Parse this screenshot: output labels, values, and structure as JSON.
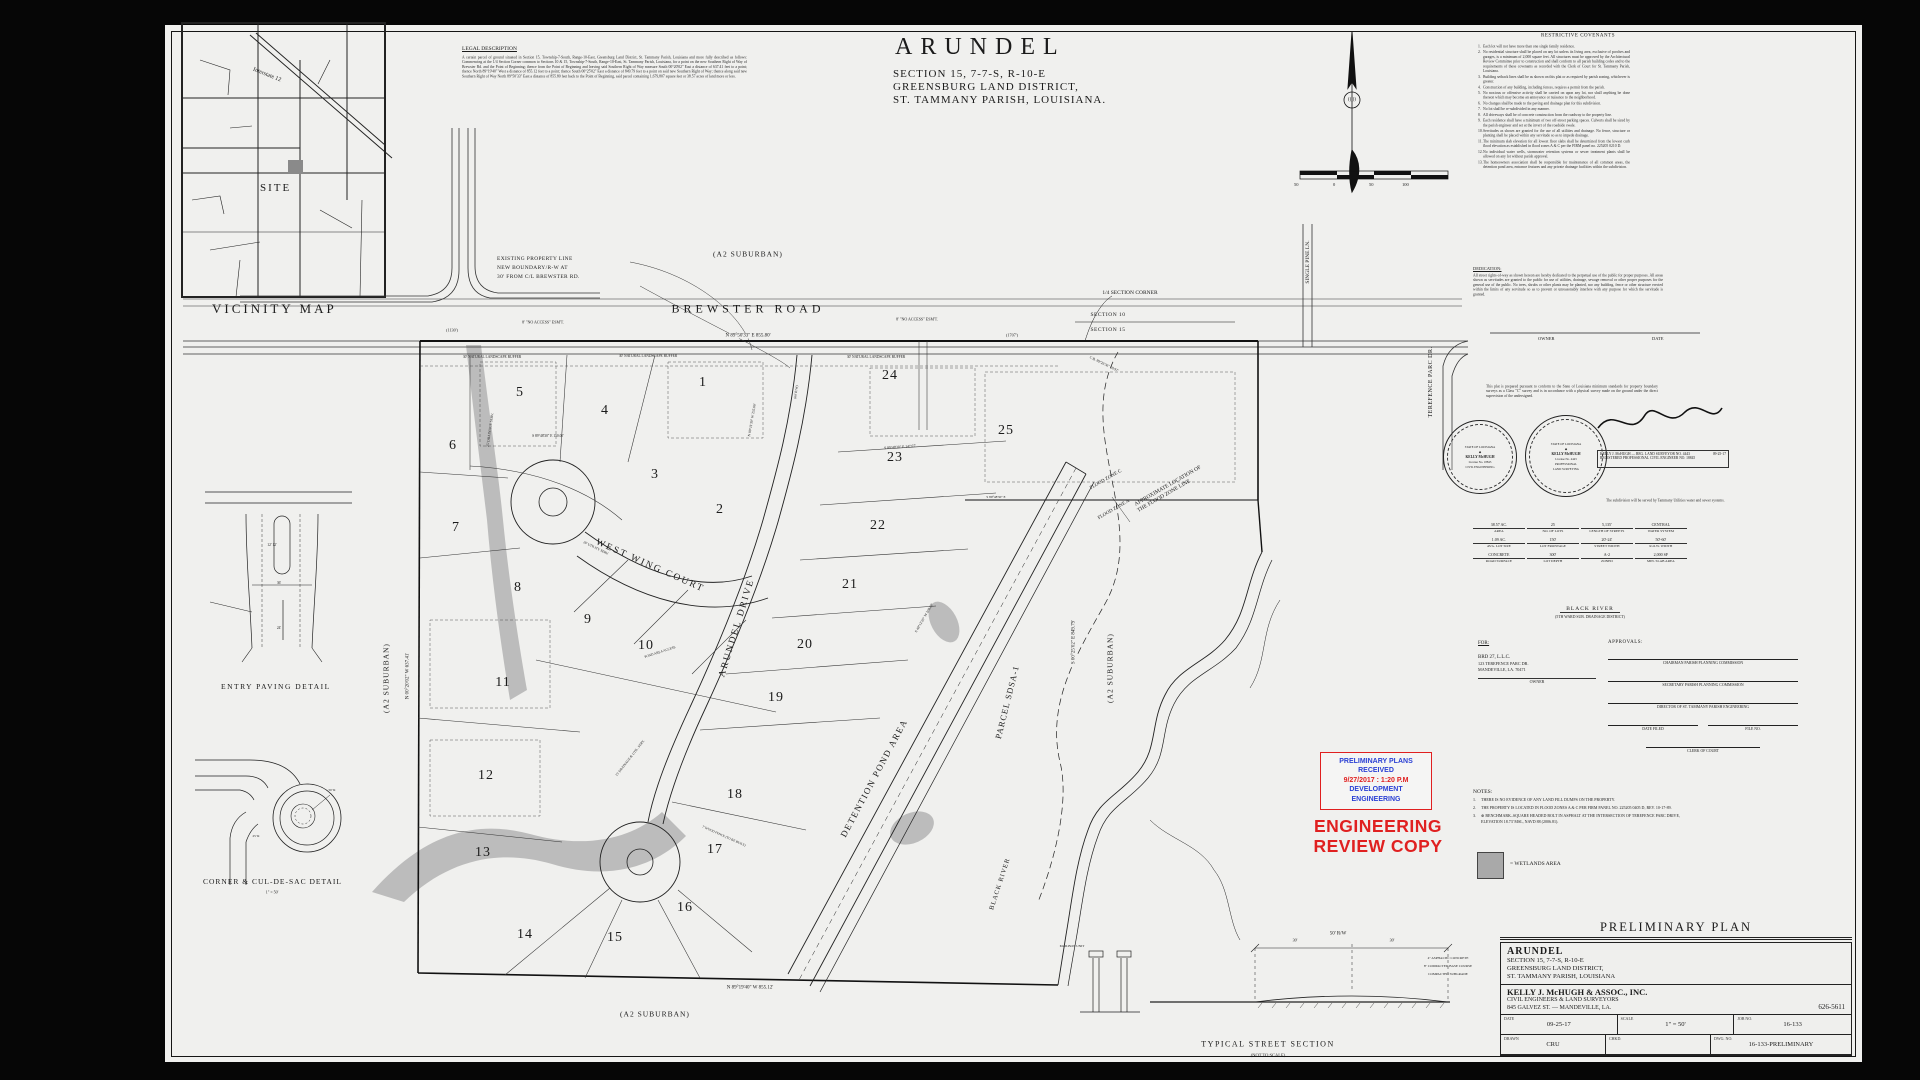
{
  "title": {
    "name": "ARUNDEL",
    "line1": "SECTION 15, 7-7-S, R-10-E",
    "line2": "GREENSBURG LAND DISTRICT,",
    "line3": "ST. TAMMANY PARISH, LOUISIANA."
  },
  "vicinity": {
    "caption": "VICINITY MAP",
    "site_label": "SITE",
    "interstate_label": "Interstate 12"
  },
  "details": {
    "entry_paving": "ENTRY PAVING DETAIL",
    "corner_culdesac": "CORNER & CUL-DE-SAC DETAIL",
    "culdesac_scale": "1\" = 50'",
    "street_section": "TYPICAL STREET SECTION",
    "street_section_scale": "(NOT TO SCALE)"
  },
  "legal": {
    "heading": "LEGAL DESCRIPTION",
    "body": "A certain parcel of ground situated in Section 15, Township-7-South, Range-10-East, Greensburg Land District, St. Tammany Parish, Louisiana and more fully described as follows:  Commencing at the 1/4 Section Corner common to Sections 10 & 15, Township-7-South, Range-10-East, St. Tammany Parish, Louisiana, for a point on the new Southern Right of Way of Brewster Rd. and the Point of Beginning; thence from the Point of Beginning and leaving said Southern Right of Way measure South 00°20'02\" East a distance of 637.41 feet to a point; thence North 89°19'40\" West a distance of 855.12 feet to a point; thence South 00°25'02\" East a distance of 849.79 feet to a point on said new Southern Right of Way; thence along said new Southern Right of Way North 89°50'33\" East a distance of 855.80 feet back to the Point of Beginning, said parcel containing 1,679,807 square feet or 38.57 acres of land more or less."
  },
  "covenants": {
    "heading": "RESTRICTIVE COVENANTS",
    "items": [
      "Each lot will not have more than one single family residence.",
      "No residential structure shall be placed on any lot unless its living area, exclusive of porches and garages, is a minimum of 2,000 square feet. All structures must be approved by the Architectural Review Committee prior to construction and shall conform to all parish building codes and to the requirements of these covenants as recorded with the Clerk of Court for St. Tammany Parish, Louisiana.",
      "Building setback lines shall be as shown on this plat or as required by parish zoning, whichever is greater.",
      "Construction of any building, including fences, requires a permit from the parish.",
      "No noxious or offensive activity shall be carried on upon any lot, nor shall anything be done thereon which may become an annoyance or nuisance to the neighborhood.",
      "No changes shall be made to the paving and drainage plan for this subdivision.",
      "No lot shall be re-subdivided in any manner.",
      "All driveways shall be of concrete construction from the roadway to the property line.",
      "Each residence shall have a minimum of two off-street parking spaces. Culverts shall be sized by the parish engineer and set at the invert of the roadside swale.",
      "Servitudes as shown are granted for the use of all utilities and drainage. No fence, structure or planting shall be placed within any servitude so as to impede drainage.",
      "The minimum slab elevation for all lowest floor slabs shall be determined from the lowest curb flood elevation as established in flood zones A & C per the FIRM panel no. 225205 0210 D.",
      "No individual water wells, stormwater retention systems or sewer treatment plants shall be allowed on any lot without parish approval.",
      "The homeowners association shall be responsible for maintenance of all common areas, the detention pond area, entrance features and any private drainage facilities within the subdivision."
    ]
  },
  "dedication": {
    "heading": "DEDICATION:",
    "body": "All street rights-of-way as shown hereon are hereby dedicated to the perpetual use of the public for proper purposes. All areas shown as servitudes are granted to the public for use of utilities, drainage, sewage removal or other proper purposes for the general use of the public. No trees, shrubs or other plants may be planted, nor any building, fence or other structure erected within the limits of any servitude so as to prevent or unreasonably interfere with any purpose for which the servitude is granted."
  },
  "certification": "This plat is prepared pursuant to conform to the State of Louisiana minimum standards for property boundary surveys as a Class \"C\" survey and is in accordance with a physical survey made on the ground under the direct supervision of the undersigned.",
  "service_note": "The subdivision will be served by Tammany Utilities water and sewer systems.",
  "owner_line": {
    "owner": "OWNER",
    "date": "DATE"
  },
  "seals": [
    {
      "state": "STATE OF LOUISIANA",
      "name": "KELLY McHUGH",
      "lic": "License No. 18845",
      "title": "REGISTERED ENGINEER",
      "field": "CIVIL ENGINEERING"
    },
    {
      "state": "STATE OF LOUISIANA",
      "name": "KELLY McHUGH",
      "lic": "License No. 4443",
      "title": "PROFESSIONAL",
      "field": "LAND SURVEYING"
    }
  ],
  "sig_box": {
    "l1": "KELLY J. McHUGH — REG. LAND SURVEYOR NO. 4443",
    "l2": "REGISTERED PROFESSIONAL CIVIL ENGINEER NO. 18845",
    "date": "09-25-17"
  },
  "statistics": [
    {
      "v": "38.57 AC.",
      "l": "AREA"
    },
    {
      "v": "25",
      "l": "NO. OF LOTS"
    },
    {
      "v": "5,135'",
      "l": "LENGTH OF STREETS"
    },
    {
      "v": "CENTRAL",
      "l": "WATER SYSTEM"
    },
    {
      "v": "1.09 AC.",
      "l": "AVG. LOT SIZE"
    },
    {
      "v": "150'",
      "l": "LOT FRONTAGE"
    },
    {
      "v": "20'-24'",
      "l": "STREET WIDTH"
    },
    {
      "v": "50'-60'",
      "l": "R.O.W. WIDTH"
    },
    {
      "v": "CONCRETE",
      "l": "ROAD SURFACE"
    },
    {
      "v": "300'",
      "l": "LOT DEPTH"
    },
    {
      "v": "A-2",
      "l": "ZONED"
    },
    {
      "v": "2,000 SF",
      "l": "MIN. SLAB AREA"
    }
  ],
  "black_river_note": {
    "l1": "BLACK RIVER",
    "l2": "(5TH WARD SUB. DRAINAGE DISTRICT)"
  },
  "for_block": {
    "heading": "FOR:",
    "owner": "BRD 27, L.L.C.",
    "addr1": "123 TEREFENCE PARC DR.",
    "addr2": "MANDEVILLE, LA. 70471",
    "label": "OWNER"
  },
  "approvals": {
    "heading": "APPROVALS:",
    "sign_lines": [
      "CHAIRMAN PARISH PLANNING COMMISSION",
      "SECRETARY PARISH PLANNING COMMISSION",
      "DIRECTOR OF ST. TAMMANY PARISH ENGINEERING"
    ],
    "half_lines": [
      "DATE FILED",
      "FILE NO."
    ],
    "clerk": "CLERK OF COURT"
  },
  "stamp": {
    "line1": "PRELIMINARY PLANS",
    "line2": "RECEIVED",
    "line3": "9/27/2017 : 1:20 P.M",
    "line4": "DEVELOPMENT",
    "line5": "ENGINEERING",
    "review1": "ENGINEERING",
    "review2": "REVIEW COPY"
  },
  "notes": {
    "heading": "NOTES:",
    "items": [
      "THERE IS NO EVIDENCE OF ANY LAND FILL DUMPS ON THE PROPERTY.",
      "THE PROPERTY IS LOCATED IN FLOOD ZONES A & C PER FIRM PANEL NO. 225205 0405 D, REV. 10-17-89.",
      "⊕ BENCHMARK–SQUARE HEADED BOLT IN ASPHALT AT THE INTERSECTION OF TEREFENCE PARC DRIVE, ELEVATION 18.73' MSL, NAVD 88 (2006.81)."
    ],
    "wetland_legend": "= WETLANDS AREA"
  },
  "north_scale": {
    "ticks": [
      "50",
      "0",
      "50",
      "100"
    ]
  },
  "titleblock": {
    "header": "PRELIMINARY PLAN",
    "project": "ARUNDEL",
    "l1": "SECTION 15, 7-7-S, R-10-E",
    "l2": "GREENSBURG LAND DISTRICT,",
    "l3": "ST. TAMMANY PARISH, LOUISIANA",
    "firm": "KELLY J. McHUGH & ASSOC., INC.",
    "firm2": "CIVIL ENGINEERS & LAND SURVEYORS",
    "firm3": "845 GALVEZ ST.  —  MANDEVILLE, LA.",
    "phone": "626-5611",
    "fields": [
      {
        "l": "DATE",
        "v": "09-25-17"
      },
      {
        "l": "SCALE",
        "v": "1\" = 50'"
      },
      {
        "l": "JOB NO.",
        "v": "16-133"
      },
      {
        "l": "DRAWN",
        "v": "CRU"
      },
      {
        "l": "CHKD.",
        "v": ""
      },
      {
        "l": "DWG. NO.",
        "v": "16-133-PRELIMINARY"
      }
    ]
  },
  "plat": {
    "roads": {
      "brewster": "BREWSTER ROAD",
      "arundel": "ARUNDEL DRIVE",
      "west_wing": "WEST WING COURT",
      "single_pine": "SINGLE PINE LN.",
      "terefence": "TEREFENCE PARC DR."
    },
    "labels": {
      "detention": "DETENTION POND AREA",
      "parcel": "PARCEL SDSA-1",
      "black_river": "BLACK RIVER",
      "flood_c": "FLOOD ZONE C",
      "flood_a": "FLOOD ZONE A",
      "flood_line1": "APPROXIMATE LOCATION OF",
      "flood_line2": "THE FLOOD ZONE LINE",
      "quarter_corner": "1/4 SECTION CORNER",
      "section10": "SECTION 10",
      "section15": "SECTION 15",
      "a2": "(A2 SUBURBAN)",
      "existing1": "EXISTING PROPERTY LINE",
      "existing2": "NEW BOUNDARY/R-W AT",
      "existing3": "30' FROM C/L BREWSTER RD."
    },
    "bearings": {
      "top": "N 89°50'33\" E   855.80'",
      "bottom": "N 89°19'40\" W   855.12'",
      "left": "N 00°20'02\" W   637.41'",
      "right": "S 00°25'02\" E   849.79'"
    },
    "lots": [
      {
        "number": "1",
        "x": 703,
        "y": 383
      },
      {
        "number": "2",
        "x": 720,
        "y": 510
      },
      {
        "number": "3",
        "x": 655,
        "y": 475
      },
      {
        "number": "4",
        "x": 605,
        "y": 411
      },
      {
        "number": "5",
        "x": 520,
        "y": 393
      },
      {
        "number": "6",
        "x": 453,
        "y": 446
      },
      {
        "number": "7",
        "x": 456,
        "y": 528
      },
      {
        "number": "8",
        "x": 518,
        "y": 588
      },
      {
        "number": "9",
        "x": 588,
        "y": 620
      },
      {
        "number": "10",
        "x": 646,
        "y": 646
      },
      {
        "number": "11",
        "x": 503,
        "y": 683
      },
      {
        "number": "12",
        "x": 486,
        "y": 776
      },
      {
        "number": "13",
        "x": 483,
        "y": 853
      },
      {
        "number": "14",
        "x": 525,
        "y": 935
      },
      {
        "number": "15",
        "x": 615,
        "y": 938
      },
      {
        "number": "16",
        "x": 685,
        "y": 908
      },
      {
        "number": "17",
        "x": 715,
        "y": 850
      },
      {
        "number": "18",
        "x": 735,
        "y": 795
      },
      {
        "number": "19",
        "x": 776,
        "y": 698
      },
      {
        "number": "20",
        "x": 805,
        "y": 645
      },
      {
        "number": "21",
        "x": 850,
        "y": 585
      },
      {
        "number": "22",
        "x": 878,
        "y": 526
      },
      {
        "number": "23",
        "x": 895,
        "y": 458
      },
      {
        "number": "24",
        "x": 890,
        "y": 376
      },
      {
        "number": "25",
        "x": 1006,
        "y": 431
      }
    ],
    "micro": [
      {
        "t": "8' \"NO ACCESS\" ESM'T.",
        "x": 543,
        "y": 322,
        "r": 0,
        "s": 4
      },
      {
        "t": "8' \"NO ACCESS\" ESM'T.",
        "x": 917,
        "y": 319,
        "r": 0,
        "s": 4
      },
      {
        "t": "(1130')",
        "x": 452,
        "y": 330,
        "r": 0,
        "s": 4.2
      },
      {
        "t": "(1707')",
        "x": 1012,
        "y": 335,
        "r": 0,
        "s": 4.2
      },
      {
        "t": "30' NATURAL LANDSCAPE BUFFER",
        "x": 492,
        "y": 357,
        "r": 0,
        "s": 3.6
      },
      {
        "t": "30' NATURAL LANDSCAPE BUFFER",
        "x": 648,
        "y": 356,
        "r": 0,
        "s": 3.6
      },
      {
        "t": "30' NATURAL LANDSCAPE BUFFER",
        "x": 876,
        "y": 357,
        "r": 0,
        "s": 3.6
      },
      {
        "t": "S 89°48'30\" E  150.00'",
        "x": 548,
        "y": 436,
        "r": 0,
        "s": 3.6
      },
      {
        "t": "S 89°48'30\" E  147.07'",
        "x": 900,
        "y": 447,
        "r": -4,
        "s": 3.6
      },
      {
        "t": "N 00°11'30\" W  255.00'",
        "x": 752,
        "y": 420,
        "r": -80,
        "s": 3.6
      },
      {
        "t": "25' DRAINAGE SERV.",
        "x": 490,
        "y": 430,
        "r": -82,
        "s": 3.6
      },
      {
        "t": "20' UTILITY SERV.",
        "x": 596,
        "y": 548,
        "r": 26,
        "s": 3.4
      },
      {
        "t": "POND AREA ACCESS",
        "x": 660,
        "y": 652,
        "r": -18,
        "s": 3.4
      },
      {
        "t": "C.B. 89°26'36\"  58.97'",
        "x": 1104,
        "y": 364,
        "r": 26,
        "s": 3.6
      },
      {
        "t": "S 48°12'20\" W  208.00'",
        "x": 924,
        "y": 618,
        "r": -60,
        "s": 3.6
      },
      {
        "t": "15' DRAINAGE & UTIL. SERV.",
        "x": 630,
        "y": 758,
        "r": -52,
        "s": 3.4
      },
      {
        "t": "7' WOOD FENCE (TO BE BUILT)",
        "x": 724,
        "y": 836,
        "r": 24,
        "s": 3.3
      },
      {
        "t": "(60' R/W)",
        "x": 796,
        "y": 392,
        "r": -82,
        "s": 3.4
      },
      {
        "t": "S 89°48'30\" E",
        "x": 996,
        "y": 497,
        "r": 0,
        "s": 3.4
      },
      {
        "t": "36'",
        "x": 279,
        "y": 583,
        "r": 0,
        "s": 3.6
      },
      {
        "t": "12'  12'",
        "x": 272,
        "y": 545,
        "r": 0,
        "s": 3.6
      },
      {
        "t": "24'",
        "x": 279,
        "y": 628,
        "r": 0,
        "s": 3.6
      },
      {
        "t": "50' R",
        "x": 332,
        "y": 790,
        "r": 0,
        "s": 3.4
      },
      {
        "t": "25' R",
        "x": 256,
        "y": 836,
        "r": 0,
        "s": 3.4
      },
      {
        "t": "50' R/W",
        "x": 1338,
        "y": 934,
        "r": 0,
        "s": 5
      },
      {
        "t": "30'",
        "x": 1295,
        "y": 940,
        "r": 0,
        "s": 4
      },
      {
        "t": "30'",
        "x": 1392,
        "y": 940,
        "r": 0,
        "s": 4
      },
      {
        "t": "4\" ASPHALTIC CONCRETE",
        "x": 1448,
        "y": 958,
        "r": 0,
        "s": 3.4
      },
      {
        "t": "8\" COMPACTED BASE COURSE",
        "x": 1448,
        "y": 966,
        "r": 0,
        "s": 3.4
      },
      {
        "t": "COMPACTED SUBGRADE",
        "x": 1448,
        "y": 974,
        "r": 0,
        "s": 3.4
      },
      {
        "t": "MAILBOX UNIT",
        "x": 1072,
        "y": 946,
        "r": 0,
        "s": 3.4
      }
    ]
  }
}
